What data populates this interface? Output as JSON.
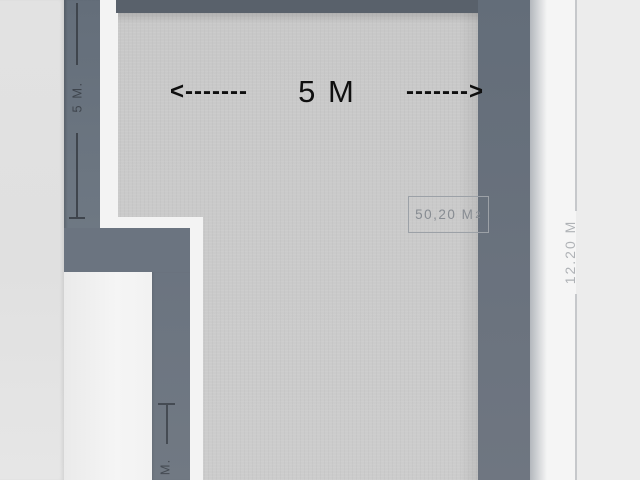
{
  "plan": {
    "dim_top": {
      "arrow_left": "<-------",
      "label": "5 M",
      "arrow_right": "------->"
    },
    "dim_left": {
      "label": "5 M."
    },
    "dim_bottom_left": {
      "label": "M."
    },
    "dim_right": {
      "label": "12.20 M"
    },
    "area_box": {
      "value": "50,20 M",
      "sup": "2"
    }
  },
  "colors": {
    "wall_side": "#6b7480",
    "wall_top": "#59616b",
    "floor": "#c8c8c8",
    "inner_edge": "#f3f3f3",
    "exterior_right_near": "#f5f5f5",
    "exterior_right_far": "#ececec",
    "dim_black": "#0f0f0f",
    "dim_dark": "#3f454d",
    "dim_light": "#afb2b6",
    "dim_line_light": "#c6c8cb",
    "area_border": "#9ca1a7",
    "area_text": "#878c92"
  }
}
